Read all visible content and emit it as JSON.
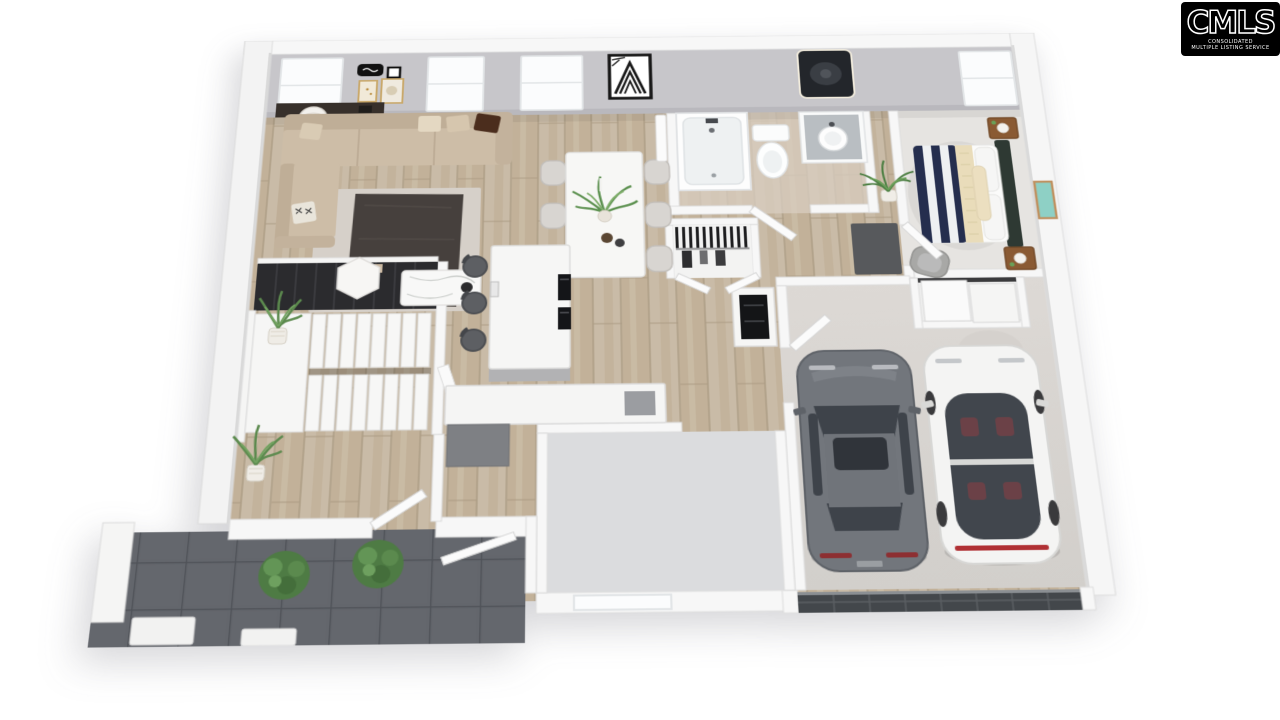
{
  "logo": {
    "brand": "CMLS",
    "tagline_line1": "CONSOLIDATED",
    "tagline_line2": "MULTIPLE LISTING SERVICE",
    "bg_color": "#000000",
    "text_color": "#ffffff"
  },
  "scene": {
    "type": "3d-floorplan-render",
    "style": "dollhouse-top-down",
    "rooms": [
      {
        "name": "living-room",
        "contents": [
          "sectional-sofa",
          "area-rug",
          "hex-coffee-table",
          "marble-coffee-table",
          "console-table",
          "round-lamp",
          "floor-plant",
          "gallery-wall-frames",
          "two-windows"
        ]
      },
      {
        "name": "dining-area",
        "contents": [
          "dining-table",
          "six-upholstered-chairs",
          "plant-centerpiece",
          "vases",
          "geometric-wall-art",
          "window"
        ]
      },
      {
        "name": "kitchen",
        "contents": [
          "island",
          "three-bar-stools",
          "built-in-black-appliances",
          "l-counter",
          "sink",
          "wall-oven-cabinet"
        ]
      },
      {
        "name": "bathroom",
        "contents": [
          "shower-tub",
          "toilet",
          "vanity-with-round-sink",
          "backlit-mirror",
          "palm-plant"
        ]
      },
      {
        "name": "hall-closet",
        "contents": [
          "hanging-clothes-rod"
        ]
      },
      {
        "name": "hallway",
        "contents": [
          "dark-runner-rug"
        ]
      },
      {
        "name": "bedroom",
        "contents": [
          "bed-navy-striped-duvet",
          "headboard",
          "two-wood-nightstands",
          "sphere-lamps",
          "gray-armchair",
          "sliding-door-closet",
          "teal-wall-art",
          "window"
        ]
      },
      {
        "name": "staircase",
        "contents": [
          "u-shaped-stair",
          "dark-upper-flight",
          "landing",
          "handrail"
        ]
      },
      {
        "name": "flex-room",
        "contents": [
          "gray-carpet",
          "window"
        ]
      },
      {
        "name": "entry-hall",
        "contents": [
          "open-front-door",
          "railing",
          "potted-plant"
        ]
      },
      {
        "name": "garage",
        "contents": [
          "gray-sedan",
          "white-sedan",
          "paneled-garage-door",
          "service-door",
          "concrete-floor"
        ]
      },
      {
        "name": "front-porch",
        "contents": [
          "dark-tile-floor",
          "two-shrubs",
          "white-column",
          "steps"
        ]
      }
    ],
    "vehicle_count": 2
  },
  "palette": {
    "background": "#ffffff",
    "wall_face": "#c7c6ca",
    "wall_top": "#f7f7f7",
    "wood_floor": "#c9bba7",
    "carpet_bedroom": "#e6e4e1",
    "carpet_flex": "#dbdcde",
    "porch_tile": "#63666c",
    "garage_concrete": "#d9d6d2",
    "rug_dark": "#46403d",
    "sofa_beige": "#cdbda7",
    "bed_navy": "#252e4e",
    "accent_cream": "#e9dcba",
    "nightstand_wood": "#8a5a33",
    "car_gray": "#72767c",
    "car_white": "#f4f4f3",
    "plant_green": "#4e7b44",
    "logo_bg": "#000000",
    "logo_text": "#ffffff"
  }
}
